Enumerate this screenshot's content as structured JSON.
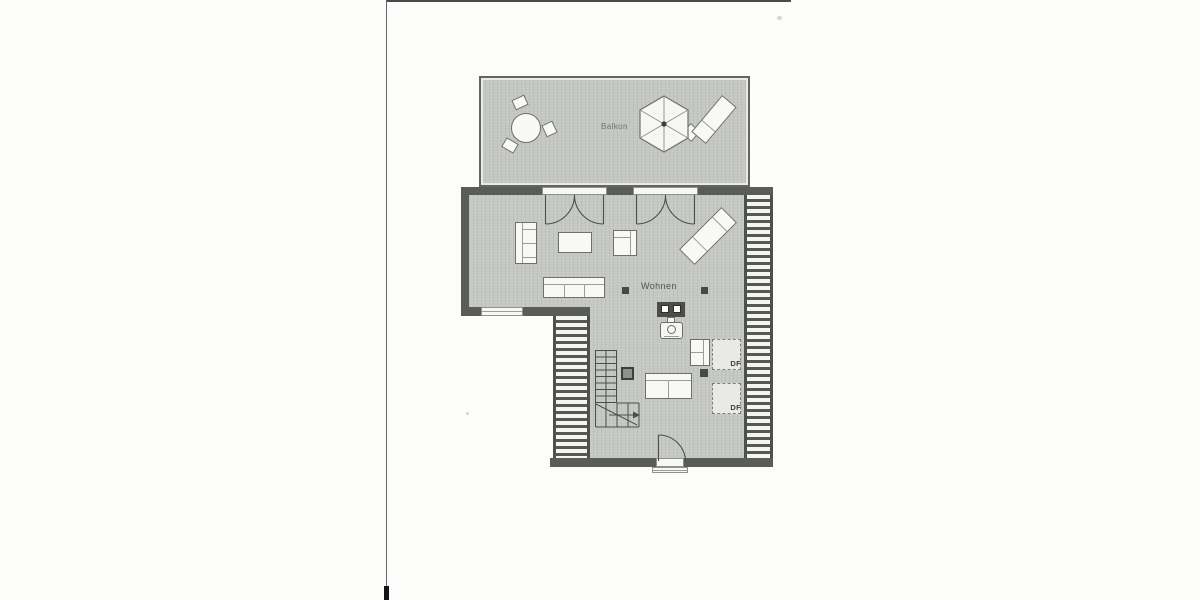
{
  "scan": {
    "kind": "attic floor plan (scanned blueprint page)",
    "labels": {
      "balcony": "Balkon",
      "living_room": "Wohnen"
    },
    "roof_windows": [
      {
        "label": "DF"
      },
      {
        "label": "DF"
      }
    ],
    "colors": {
      "paper": "#fcfcfb",
      "floor_fill": "#c6c8c6",
      "wall": "#5a5c5a",
      "furniture_fill": "#f8f8f6",
      "outline": "#6e706e",
      "roof_window_fill": "#e9eae6"
    },
    "icons": [
      "round-table-icon",
      "balcony-chair-icon",
      "parasol-icon",
      "sun-lounger-icon",
      "loveseat-icon",
      "coffee-table-icon",
      "armchair-icon",
      "recliner-icon",
      "sofa-icon",
      "wood-stove-icon",
      "column-post-icon",
      "staircase-icon",
      "roof-window-icon",
      "double-balcony-door-icon",
      "entry-door-icon",
      "roof-slope-hatch-icon",
      "window-icon"
    ]
  }
}
